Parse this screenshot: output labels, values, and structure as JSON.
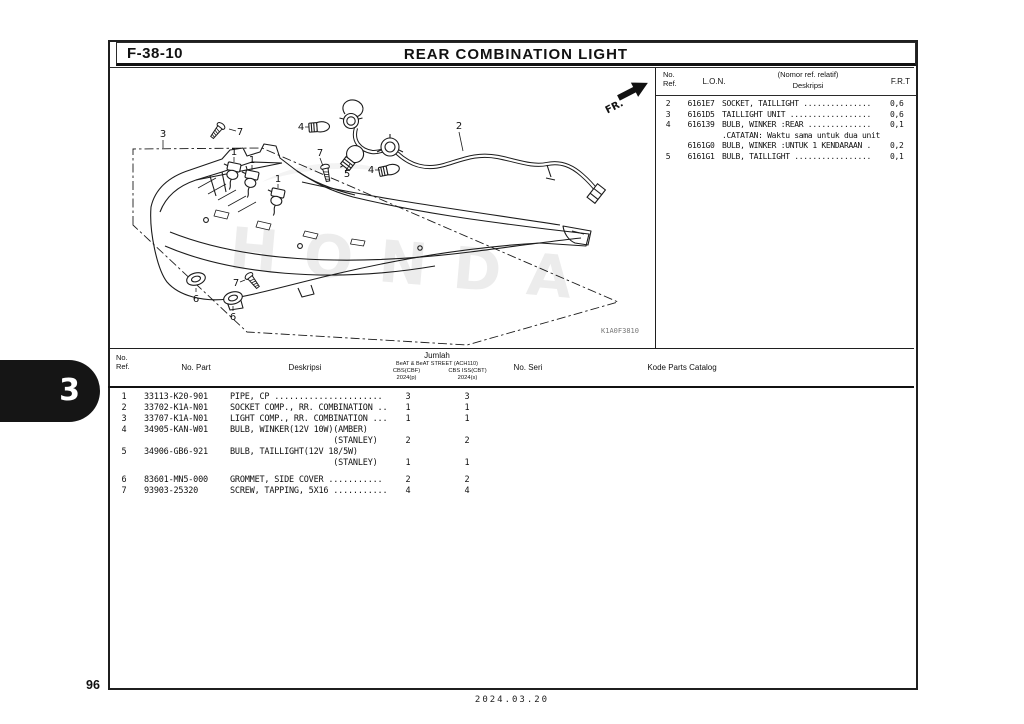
{
  "header": {
    "figure_code": "F-38-10",
    "title": "REAR COMBINATION LIGHT"
  },
  "side_tab": {
    "number": "3"
  },
  "footer": {
    "page_number": "96",
    "date": "2024.03.20"
  },
  "diagram": {
    "code": "K1A0F3810",
    "fr_label": "FR.",
    "watermark": "HONDA",
    "callouts": [
      "3",
      "7",
      "1",
      "1",
      "1",
      "4",
      "7",
      "5",
      "4",
      "2",
      "6",
      "7",
      "6"
    ]
  },
  "ref_table": {
    "headers": {
      "no_ref": "No.\nRef.",
      "lon": "L.O.N.",
      "deskripsi_top": "(Nomor ref. relatif)",
      "deskripsi": "Deskripsi",
      "frt": "F.R.T"
    },
    "rows": [
      {
        "ref": "2",
        "lon": "6161E7",
        "desc": "SOCKET, TAILLIGHT ...............",
        "frt": "0,6"
      },
      {
        "ref": "3",
        "lon": "6161D5",
        "desc": "TAILLIGHT UNIT ..................",
        "frt": "0,6"
      },
      {
        "ref": "4",
        "lon": "616139",
        "desc": "BULB, WINKER :REAR ..............",
        "frt": "0,1"
      },
      {
        "ref": "",
        "lon": "",
        "desc": ".CATATAN: Waktu sama untuk dua unit",
        "frt": ""
      },
      {
        "ref": "",
        "lon": "6161G0",
        "desc": "BULB, WINKER :UNTUK 1 KENDARAAN .",
        "frt": "0,2"
      },
      {
        "ref": "5",
        "lon": "6161G1",
        "desc": "BULB, TAILLIGHT .................",
        "frt": "0,1"
      }
    ]
  },
  "parts_table": {
    "headers": {
      "no_ref": "No.\nRef.",
      "no_part": "No. Part",
      "deskripsi": "Deskripsi",
      "jumlah": "Jumlah",
      "model": "BeAT & BeAT STREET (ACH110)",
      "variant_left": "CBS(CBF)",
      "variant_right": "CBS ISS(CBT)",
      "year_left": "2024(p)",
      "year_right": "2024(s)",
      "no_seri": "No. Seri",
      "kode": "Kode Parts Catalog"
    },
    "rows": [
      {
        "ref": "1",
        "part": "33113-K20-901",
        "desc": "PIPE, CP ......................",
        "q1": "3",
        "q2": "3"
      },
      {
        "ref": "2",
        "part": "33702-K1A-N01",
        "desc": "SOCKET COMP., RR. COMBINATION ..",
        "q1": "1",
        "q2": "1"
      },
      {
        "ref": "3",
        "part": "33707-K1A-N01",
        "desc": "LIGHT COMP., RR. COMBINATION ...",
        "q1": "1",
        "q2": "1"
      },
      {
        "ref": "4",
        "part": "34905-KAN-W01",
        "desc": "BULB, WINKER(12V 10W)(AMBER)",
        "q1": "",
        "q2": ""
      },
      {
        "ref": "",
        "part": "",
        "desc": "                     (STANLEY)",
        "q1": "2",
        "q2": "2"
      },
      {
        "ref": "5",
        "part": "34906-GB6-921",
        "desc": "BULB, TAILLIGHT(12V 18/5W)",
        "q1": "",
        "q2": ""
      },
      {
        "ref": "",
        "part": "",
        "desc": "                     (STANLEY)",
        "q1": "1",
        "q2": "1"
      },
      {
        "ref": "6",
        "part": "83601-MN5-000",
        "desc": "GROMMET, SIDE COVER ...........",
        "q1": "2",
        "q2": "2"
      },
      {
        "ref": "7",
        "part": "93903-25320",
        "desc": "SCREW, TAPPING, 5X16 ...........",
        "q1": "4",
        "q2": "4"
      }
    ]
  }
}
